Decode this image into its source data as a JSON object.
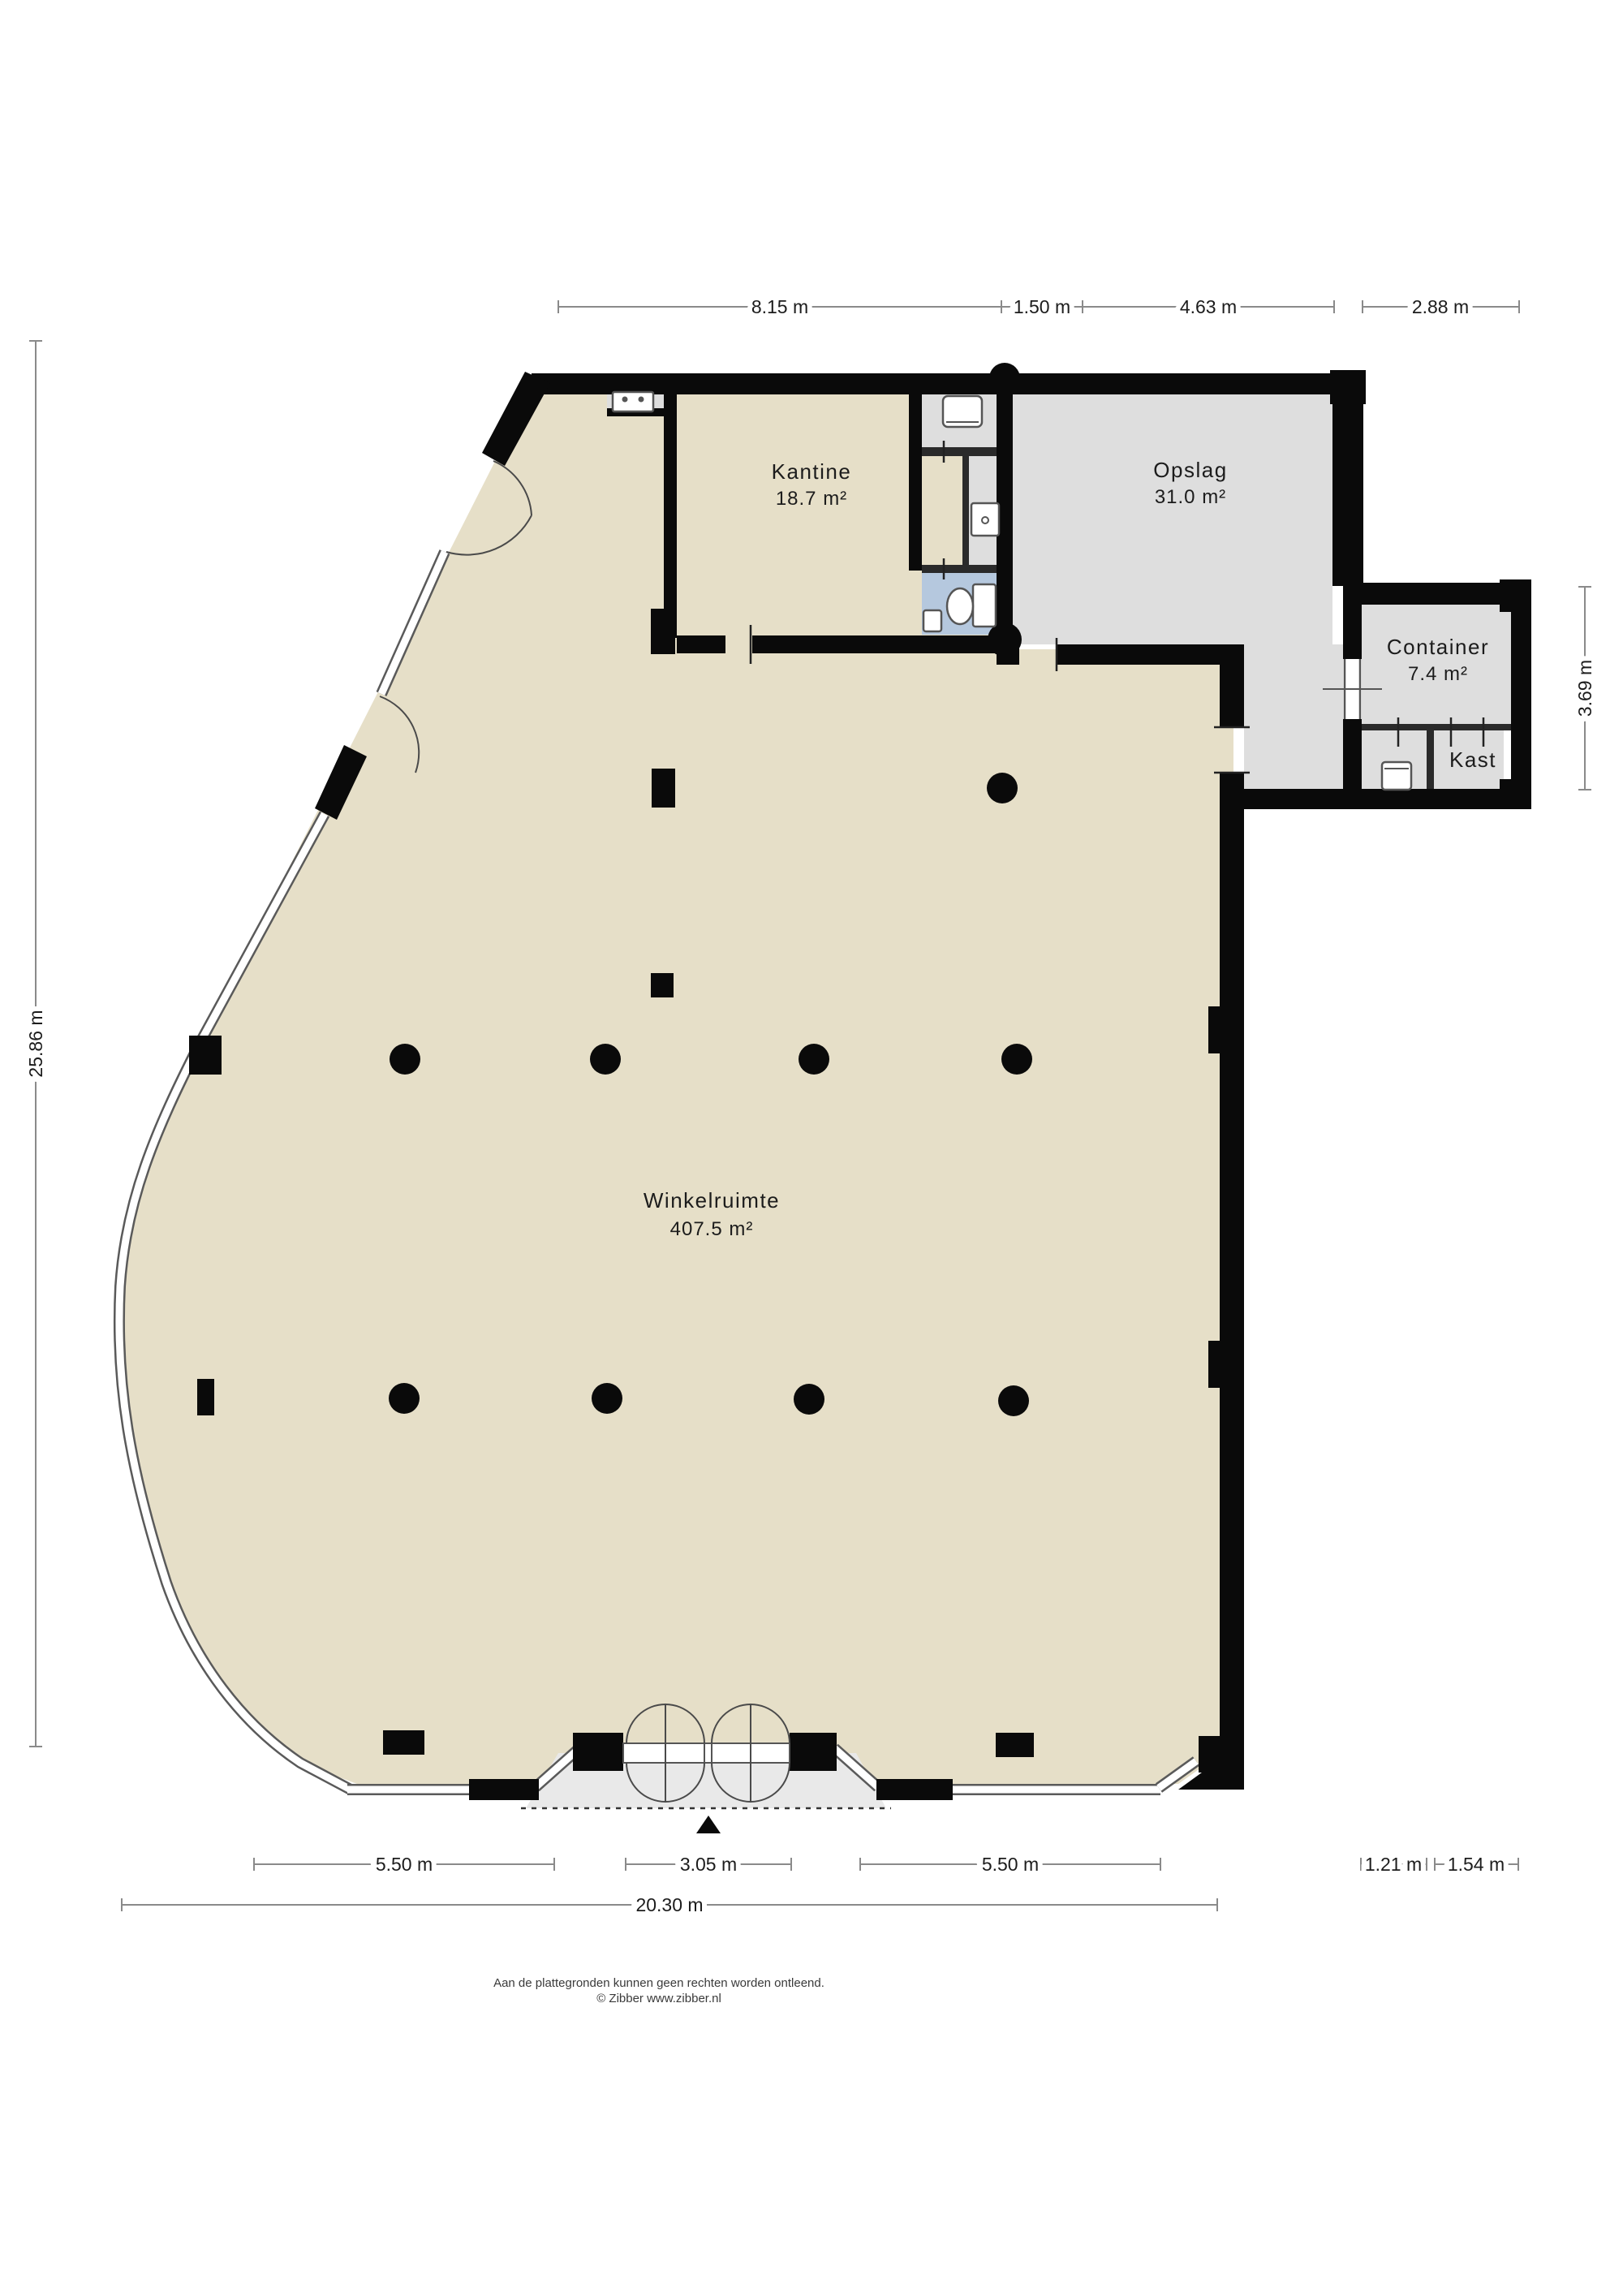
{
  "plan": {
    "rooms": {
      "winkelruimte": {
        "name": "Winkelruimte",
        "area": "407.5 m²"
      },
      "kantine": {
        "name": "Kantine",
        "area": "18.7 m²"
      },
      "opslag": {
        "name": "Opslag",
        "area": "31.0 m²"
      },
      "container": {
        "name": "Container",
        "area": "7.4 m²"
      },
      "kast": {
        "name": "Kast"
      }
    },
    "dimensions": {
      "top": [
        "8.15 m",
        "1.50 m",
        "4.63 m",
        "2.88 m"
      ],
      "left": "25.86 m",
      "right": "3.69 m",
      "bottom": [
        "5.50 m",
        "3.05 m",
        "5.50 m",
        "1.21 m",
        "1.54 m"
      ],
      "total_width": "20.30 m"
    },
    "footer": {
      "line1": "Aan de plattegronden kunnen geen rechten worden ontleend.",
      "line2": "© Zibber www.zibber.nl"
    },
    "colors": {
      "floor_beige": "#e6dfc8",
      "room_gray": "#dedede",
      "toilet_blue": "#b5c8de",
      "wall_black": "#0a0a0a"
    }
  }
}
